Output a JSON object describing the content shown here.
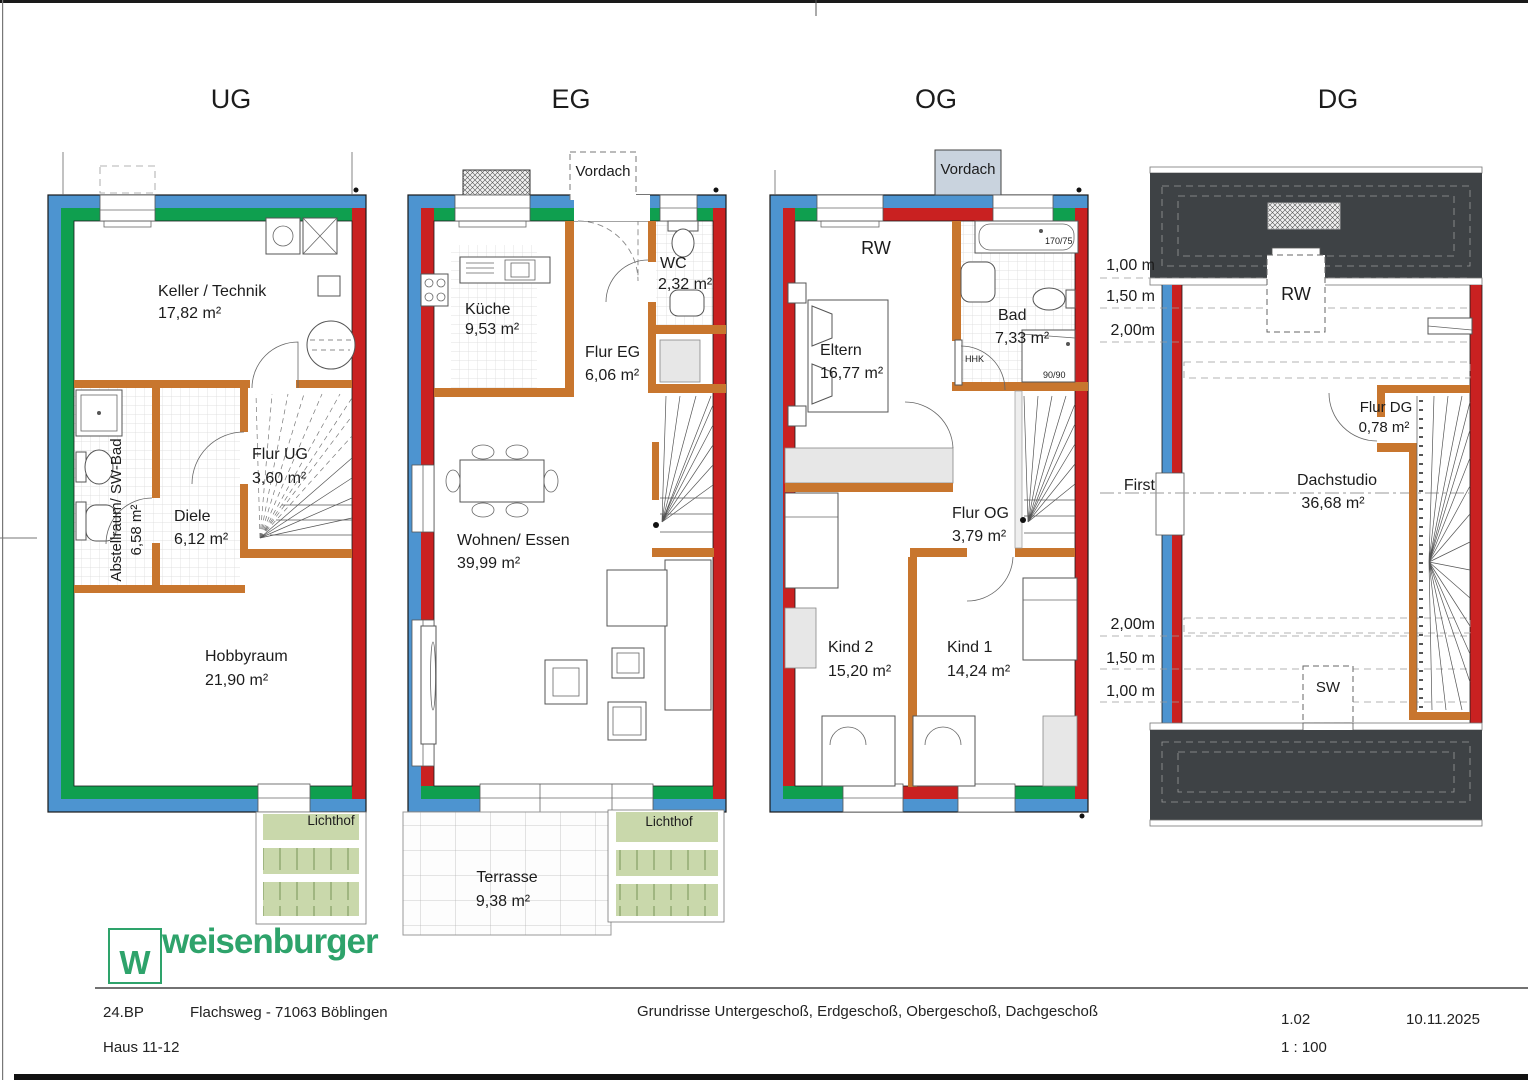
{
  "colors": {
    "wall_blue": "#4d94d0",
    "wall_green": "#0f9f4f",
    "wall_red": "#c92121",
    "wall_orange": "#c8762e",
    "roof_gray": "#3e4245",
    "lichthof_green": "#c9d8ab",
    "vordach_fill": "#c9d3de",
    "logo_green": "#2ea36b"
  },
  "titles": {
    "ug": "UG",
    "eg": "EG",
    "og": "OG",
    "dg": "DG"
  },
  "ug": {
    "keller_name": "Keller / Technik",
    "keller_area": "17,82 m²",
    "abstell_name": "Abstellraum/ SW-Bad",
    "abstell_area": "6,58 m²",
    "diele_name": "Diele",
    "diele_area": "6,12 m²",
    "flur_name": "Flur UG",
    "flur_area": "3,60 m²",
    "hobby_name": "Hobbyraum",
    "hobby_area": "21,90 m²",
    "lichthof": "Lichthof"
  },
  "eg": {
    "vordach": "Vordach",
    "kueche_name": "Küche",
    "kueche_area": "9,53 m²",
    "wc_name": "WC",
    "wc_area": "2,32 m²",
    "flur_name": "Flur EG",
    "flur_area": "6,06 m²",
    "wohnen_name": "Wohnen/ Essen",
    "wohnen_area": "39,99 m²",
    "terrasse_name": "Terrasse",
    "terrasse_area": "9,38 m²",
    "lichthof": "Lichthof"
  },
  "og": {
    "vordach": "Vordach",
    "rw": "RW",
    "eltern_name": "Eltern",
    "eltern_area": "16,77 m²",
    "bad_name": "Bad",
    "bad_area": "7,33 m²",
    "tub": "170/75",
    "hhk": "HHK",
    "shower": "90/90",
    "flur_name": "Flur OG",
    "flur_area": "3,79 m²",
    "kind2_name": "Kind 2",
    "kind2_area": "15,20 m²",
    "kind1_name": "Kind 1",
    "kind1_area": "14,24 m²"
  },
  "dg": {
    "rw": "RW",
    "sw": "SW",
    "first": "First",
    "flur_name": "Flur DG",
    "flur_area": "0,78 m²",
    "studio_name": "Dachstudio",
    "studio_area": "36,68 m²",
    "h100": "1,00 m",
    "h150": "1,50 m",
    "h200": "2,00m",
    "h200b": "2,00m",
    "h150b": "1,50 m",
    "h100b": "1,00 m"
  },
  "footer": {
    "project": "24.BP",
    "address": "Flachsweg - 71063 Böblingen",
    "house": "Haus 11-12",
    "drawing_title": "Grundrisse Untergeschoß, Erdgeschoß, Obergeschoß, Dachgeschoß",
    "sheet_no": "1.02",
    "date": "10.11.2025",
    "scale": "1 : 100"
  },
  "logo": {
    "brand": "weisenburger",
    "mark": "W"
  }
}
